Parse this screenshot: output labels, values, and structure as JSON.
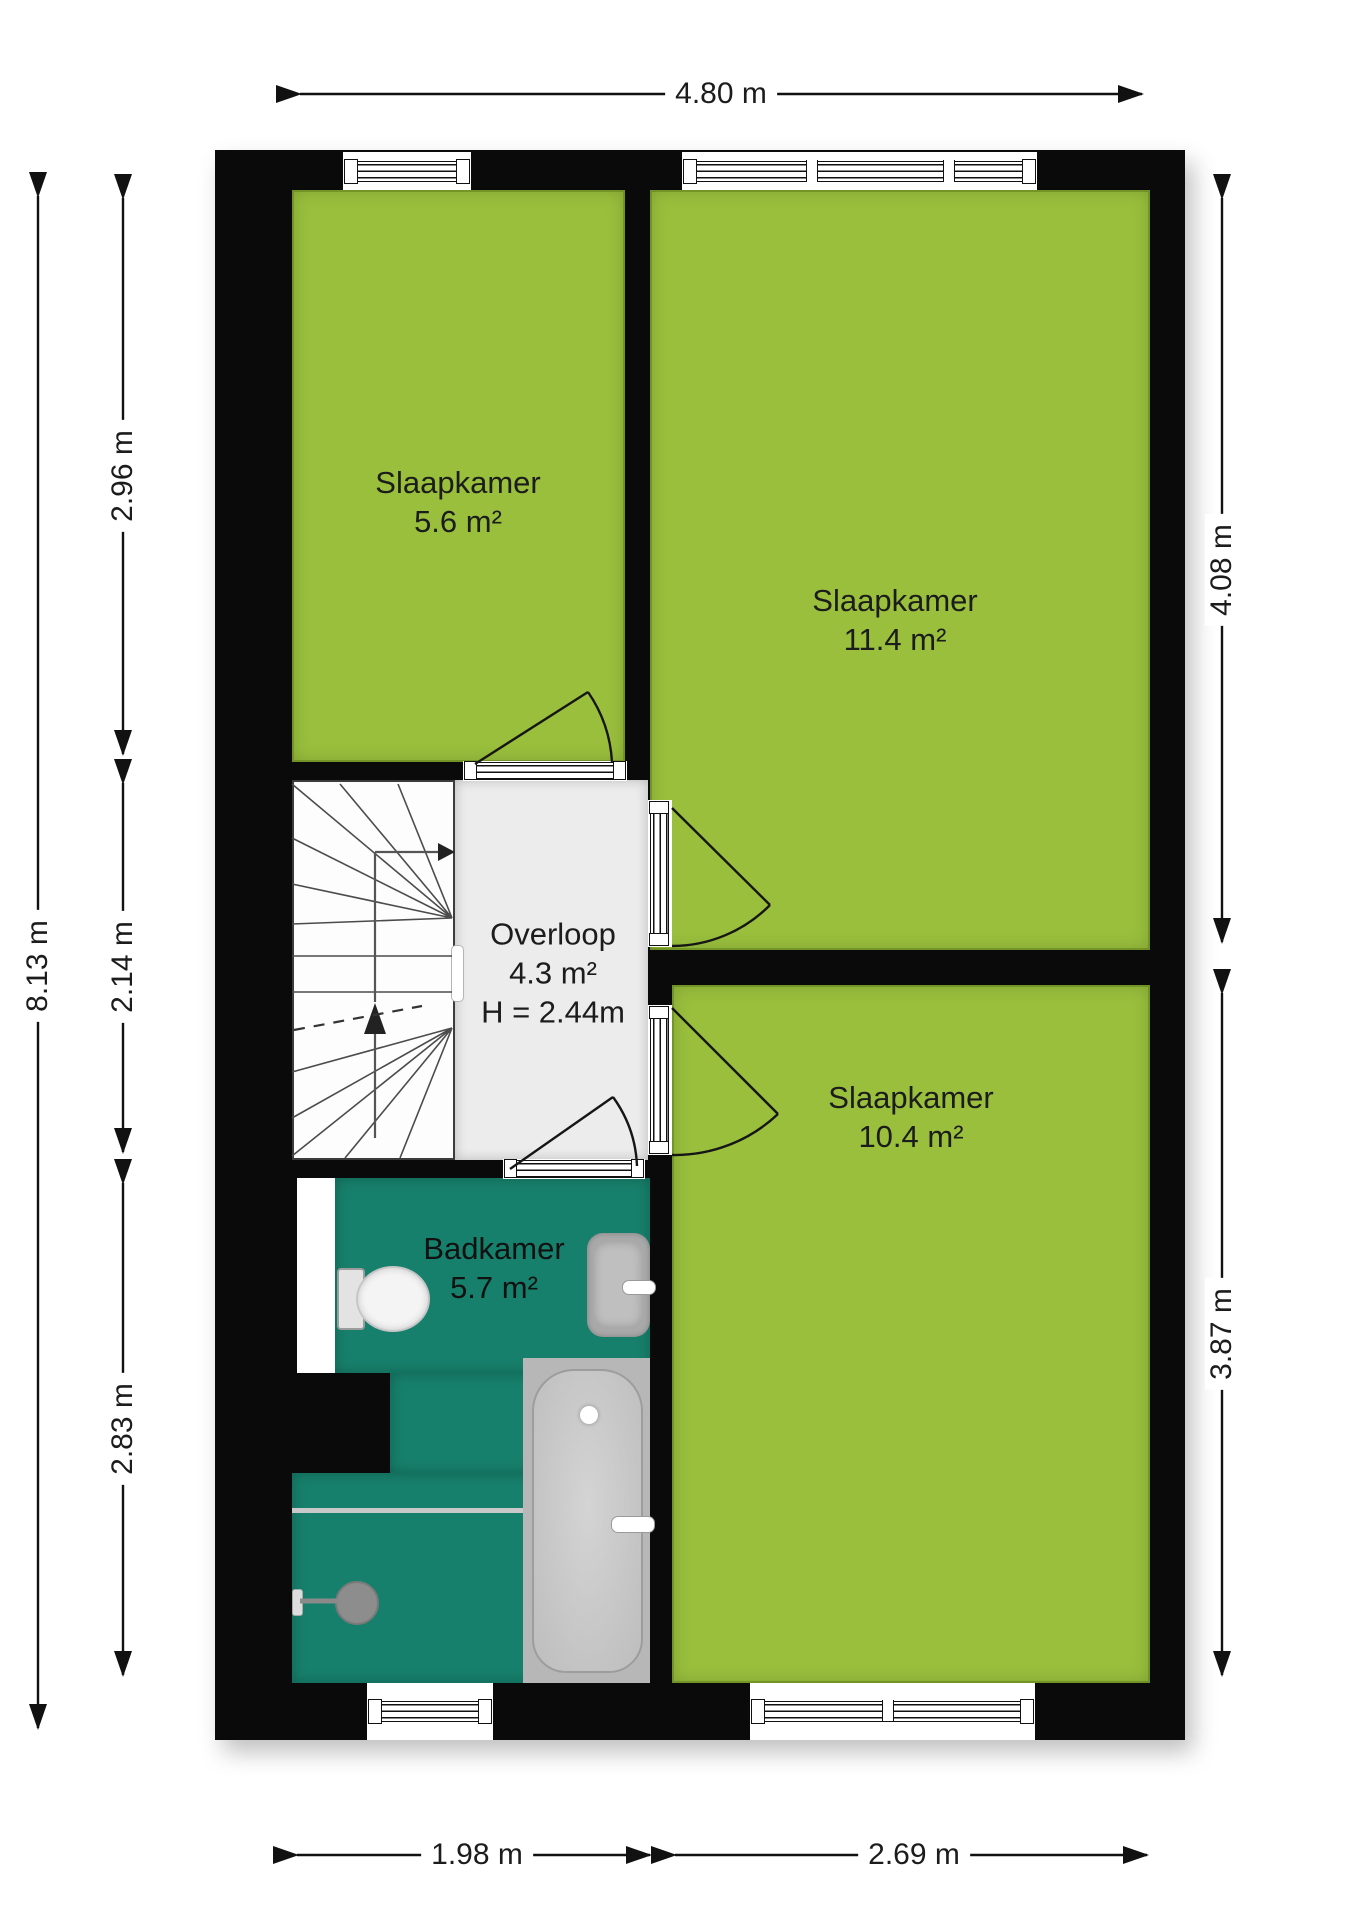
{
  "floorplan": {
    "rooms": [
      {
        "name": "Slaapkamer",
        "area": "5.6 m²"
      },
      {
        "name": "Slaapkamer",
        "area": "11.4 m²"
      },
      {
        "name": "Overloop",
        "area": "4.3 m²",
        "height": "H = 2.44m"
      },
      {
        "name": "Badkamer",
        "area": "5.7 m²"
      },
      {
        "name": "Slaapkamer",
        "area": "10.4 m²"
      }
    ],
    "dimensions": {
      "top": "4.80 m",
      "left_total": "8.13 m",
      "left_segments": [
        "2.96 m",
        "2.14 m",
        "2.83 m"
      ],
      "right_segments": [
        "4.08 m",
        "3.87 m"
      ],
      "bottom_segments": [
        "1.98 m",
        "2.69 m"
      ]
    },
    "colors": {
      "room_green": "#99BF3D",
      "bathroom_teal": "#17806C",
      "wall_black": "#0a0a0a",
      "hall_gray": "#ECECEC"
    },
    "fixtures": [
      {
        "icon": "stairs-icon"
      },
      {
        "icon": "toilet-icon"
      },
      {
        "icon": "sink-icon"
      },
      {
        "icon": "bathtub-icon"
      },
      {
        "icon": "shower-icon"
      }
    ]
  }
}
